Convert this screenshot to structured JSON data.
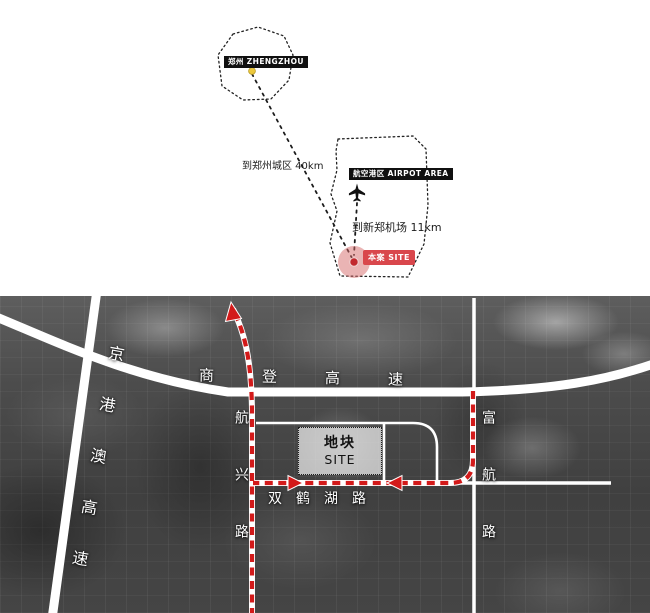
{
  "diagram": {
    "zhengzhou": {
      "label": "郑州 ZHENGZHOU",
      "distance": "到郑州城区 40km"
    },
    "airport": {
      "label": "航空港区 AIRPOT AREA",
      "distance": "到新郑机场 11km"
    },
    "site": {
      "label": "本案 SITE"
    },
    "colors": {
      "city_marker_yellow": "#ecc83d",
      "site_circle_pink": "#d66a6a",
      "site_dot_red": "#c2282e",
      "tag_red": "#d9474c"
    }
  },
  "map": {
    "road_labels": {
      "jinggangao_expressway": "京港澳高速",
      "shangdeng_expressway": "商登高速",
      "hangxing_road": "航兴路",
      "shuanghehu_road": "双鹤湖路",
      "fuhang_road": "富航路"
    },
    "site_block": {
      "title": "地块",
      "subtitle": "SITE"
    },
    "colors": {
      "route_red": "#d31a1a",
      "road_white": "#ffffff"
    }
  }
}
